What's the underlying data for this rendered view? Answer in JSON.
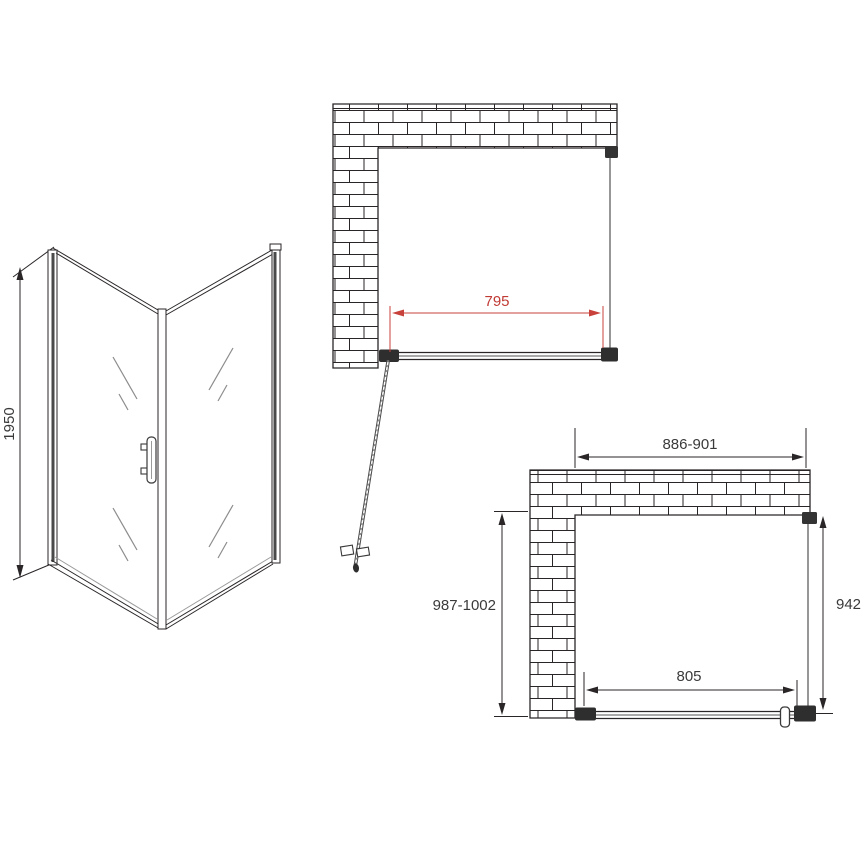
{
  "drawing": {
    "type": "shower-enclosure-installation-diagram",
    "views": {
      "isometric": {
        "name": "isometric product view",
        "height_label": "1950"
      },
      "plan_top": {
        "name": "top plan view with door open",
        "door_width_label": "795"
      },
      "plan_bottom": {
        "name": "top plan view with door closed",
        "overall_width_label": "886-901",
        "overall_depth_label": "987-1002",
        "side_panel_label": "942",
        "door_opening_label": "805"
      }
    },
    "colors": {
      "ink": "#2a2627",
      "dimension_text": "#3a3a3a",
      "red_dimension": "#c13a34",
      "glass_gray": "#8c8c8c",
      "background": "#ffffff"
    }
  }
}
